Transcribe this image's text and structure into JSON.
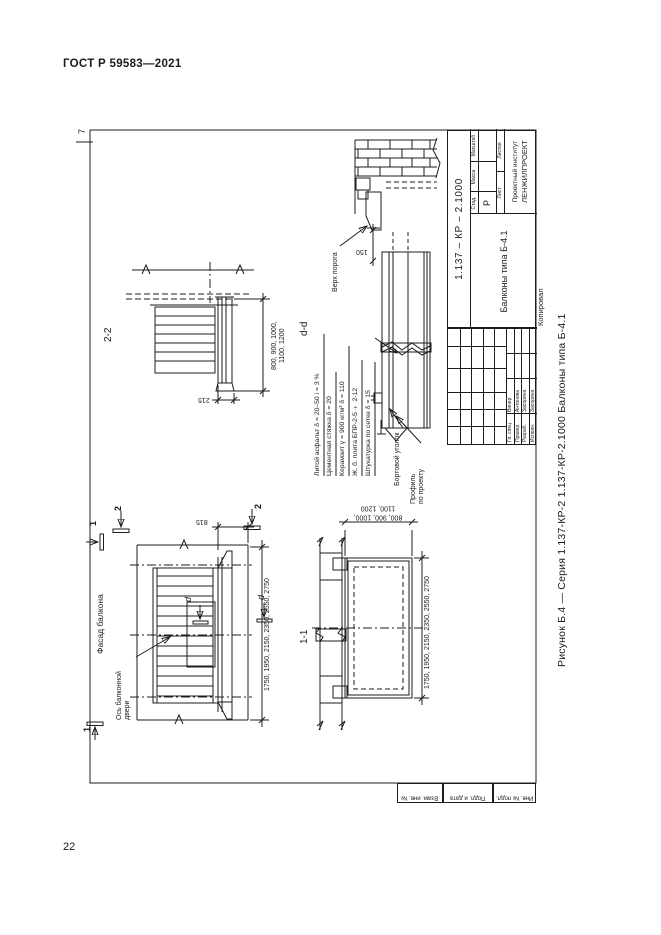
{
  "page": {
    "header": "ГОСТ Р 59583—2021",
    "page_number": "22",
    "corner_mark": "7"
  },
  "caption": "Рисунок Б.4 — Серия 1.137-КР-2 1.137-КР-2.1000 Балконы типа Б-4.1",
  "dims_shared": {
    "width": "1750, 1950, 2150, 2350, 2550, 2750",
    "depth_line1": "800, 900, 1000,",
    "depth_line2": "1100, 1200"
  },
  "marks": {
    "one": "1",
    "two": "2",
    "d": "d"
  },
  "views": {
    "section22": {
      "label": "2-2",
      "dim_edge": "215"
    },
    "detail_dd": {
      "label": "d-d",
      "threshold_label": "Верх порога",
      "dim_150": "150",
      "layers": [
        "Литой асфальт δ = 20–50 i = 3 %",
        "Цементная стяжка δ = 20",
        "Керамзит γ = 900 кг/м³ δ = 110",
        "Ж. б. плита БПР-2-5 ÷ 2-12",
        "Штукатурка по сетке δ = 15"
      ],
      "edge_angle_label": "Бортовой уголок",
      "profile_line1": "Профиль",
      "profile_line2": "по проекту"
    },
    "facade": {
      "title": "Фасад балкона",
      "axis_line1": "Ось балконной",
      "axis_line2": "двери",
      "dim_axis": "815"
    },
    "plan11": {
      "label": "1-1"
    }
  },
  "title_block": {
    "designation": "1.137 – КР – 2.1000",
    "title": "Балконы типа Б-4.1",
    "stage_header": "Стад.",
    "mass_header": "Масса",
    "scale_header": "Масштаб",
    "stage_value": "Р",
    "sheet_header": "Лист",
    "sheets_header": "Листов",
    "organization_line1": "Проектный институт",
    "organization_line2": "ЛЕНЖИЛПРОЕКТ",
    "signatories": [
      {
        "role": "Гл. спец.",
        "name": "Винер"
      },
      {
        "role": "Провер.",
        "name": "Антонова"
      },
      {
        "role": "Разраб.",
        "name": "Засорина"
      },
      {
        "role": "Исполн.",
        "name": "Засорина"
      }
    ],
    "copied_by": "Копировал"
  },
  "side_stamp": [
    "Взам. инв. №",
    "Подп. и дата",
    "Инв. № подл."
  ]
}
